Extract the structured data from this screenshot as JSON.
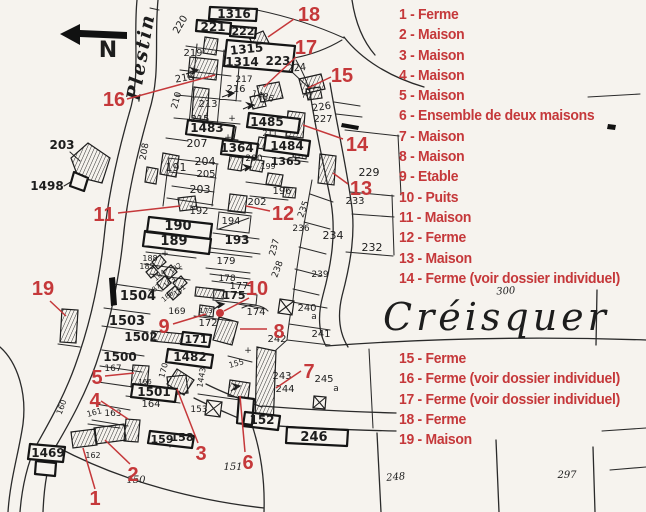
{
  "colors": {
    "red": "#c5383a",
    "ink": "#1d1d1d",
    "paper": "#f6f3ee"
  },
  "place": {
    "name": "Créisquer",
    "road_name": "Plestin",
    "north_label": "N"
  },
  "legend": {
    "group1": [
      "1 - Ferme",
      "2 - Maison",
      "3 - Maison",
      "4 - Maison",
      "5 - Maison",
      "6 - Ensemble de deux maisons",
      "7 - Maison",
      "8 - Maison",
      "9 - Etable",
      "10 - Puits",
      "11 - Maison",
      "12 - Ferme",
      "13 - Maison",
      "14 - Ferme (voir dossier individuel)"
    ],
    "group2": [
      "15 - Ferme",
      "16 - Ferme (voir dossier individuel)",
      "17 - Ferme (voir dossier individuel)",
      "18 - Ferme",
      "19 - Maison"
    ]
  },
  "well_dot": {
    "x": 220,
    "y": 313,
    "r": 4
  },
  "red_markers": [
    {
      "n": "1",
      "x": 95,
      "y": 505,
      "l": [
        95,
        489,
        83,
        448
      ]
    },
    {
      "n": "2",
      "x": 133,
      "y": 481,
      "l": [
        130,
        464,
        105,
        440
      ]
    },
    {
      "n": "3",
      "x": 201,
      "y": 460,
      "l": [
        198,
        443,
        177,
        389
      ]
    },
    {
      "n": "4",
      "x": 95,
      "y": 407,
      "l": [
        101,
        401,
        128,
        419
      ]
    },
    {
      "n": "5",
      "x": 97,
      "y": 384,
      "l": [
        105,
        376,
        134,
        373
      ]
    },
    {
      "n": "6",
      "x": 248,
      "y": 469,
      "l": [
        245,
        452,
        240,
        396
      ]
    },
    {
      "n": "7",
      "x": 309,
      "y": 378,
      "l": [
        301,
        371,
        276,
        388
      ]
    },
    {
      "n": "8",
      "x": 279,
      "y": 338,
      "l": [
        267,
        329,
        240,
        329
      ]
    },
    {
      "n": "9",
      "x": 164,
      "y": 333,
      "l": [
        173,
        324,
        206,
        314
      ]
    },
    {
      "n": "10",
      "x": 257,
      "y": 295,
      "l": [
        249,
        298,
        224,
        311
      ]
    },
    {
      "n": "11",
      "x": 104,
      "y": 221,
      "l": [
        118,
        213,
        180,
        206
      ]
    },
    {
      "n": "12",
      "x": 283,
      "y": 220,
      "l": [
        270,
        211,
        246,
        206
      ]
    },
    {
      "n": "13",
      "x": 361,
      "y": 195,
      "l": [
        348,
        184,
        333,
        173
      ]
    },
    {
      "n": "14",
      "x": 357,
      "y": 151,
      "l": [
        343,
        139,
        303,
        125
      ]
    },
    {
      "n": "15",
      "x": 342,
      "y": 82,
      "l": [
        331,
        77,
        308,
        88
      ]
    },
    {
      "n": "16",
      "x": 114,
      "y": 106,
      "l": [
        127,
        99,
        215,
        75
      ]
    },
    {
      "n": "17",
      "x": 306,
      "y": 54,
      "l": [
        296,
        57,
        264,
        87
      ]
    },
    {
      "n": "18",
      "x": 309,
      "y": 21,
      "l": [
        294,
        19,
        268,
        37
      ]
    },
    {
      "n": "19",
      "x": 43,
      "y": 295,
      "l": [
        50,
        301,
        66,
        316
      ]
    }
  ],
  "map_labels": [
    {
      "t": "1316",
      "x": 234,
      "y": 18,
      "s": 12,
      "c": "b"
    },
    {
      "t": "221",
      "x": 213,
      "y": 31,
      "s": 12,
      "c": "b"
    },
    {
      "t": "222",
      "x": 243,
      "y": 35,
      "s": 11,
      "c": "b"
    },
    {
      "t": "1315",
      "x": 247,
      "y": 53,
      "s": 12,
      "r": -6,
      "c": "b"
    },
    {
      "t": "1314",
      "x": 242,
      "y": 66,
      "s": 12,
      "c": "b"
    },
    {
      "t": "223",
      "x": 278,
      "y": 65,
      "s": 12,
      "c": "b"
    },
    {
      "t": "224",
      "x": 297,
      "y": 71,
      "s": 10,
      "r": -6
    },
    {
      "t": "225",
      "x": 312,
      "y": 93,
      "s": 9,
      "r": -65
    },
    {
      "t": "220",
      "x": 183,
      "y": 26,
      "s": 10,
      "r": -60
    },
    {
      "t": "219",
      "x": 193,
      "y": 56,
      "s": 10
    },
    {
      "t": "218",
      "x": 185,
      "y": 81,
      "s": 10,
      "r": -10
    },
    {
      "t": "217",
      "x": 244,
      "y": 82,
      "s": 9
    },
    {
      "t": "216",
      "x": 236,
      "y": 92,
      "s": 10
    },
    {
      "t": "213",
      "x": 208,
      "y": 107,
      "s": 10
    },
    {
      "t": "215",
      "x": 200,
      "y": 122,
      "s": 10
    },
    {
      "t": "210",
      "x": 179,
      "y": 101,
      "s": 9,
      "r": -75
    },
    {
      "t": "208",
      "x": 147,
      "y": 152,
      "s": 9,
      "r": -80
    },
    {
      "t": "1483",
      "x": 207,
      "y": 132,
      "s": 12,
      "c": "b"
    },
    {
      "t": "207",
      "x": 197,
      "y": 147,
      "s": 11
    },
    {
      "t": "1364",
      "x": 237,
      "y": 152,
      "s": 12,
      "c": "b"
    },
    {
      "t": "1485",
      "x": 267,
      "y": 126,
      "s": 12,
      "c": "b"
    },
    {
      "t": "1486",
      "x": 262,
      "y": 99,
      "s": 9,
      "r": 15
    },
    {
      "t": "1484",
      "x": 287,
      "y": 150,
      "s": 12,
      "c": "b"
    },
    {
      "t": "1365",
      "x": 286,
      "y": 165,
      "s": 11,
      "c": "b"
    },
    {
      "t": "226",
      "x": 322,
      "y": 110,
      "s": 10,
      "r": -8
    },
    {
      "t": "227",
      "x": 323,
      "y": 122,
      "s": 10
    },
    {
      "t": "200",
      "x": 254,
      "y": 161,
      "s": 9
    },
    {
      "t": "199",
      "x": 268,
      "y": 169,
      "s": 8
    },
    {
      "t": "211",
      "x": 270,
      "y": 136,
      "s": 8
    },
    {
      "t": "196",
      "x": 282,
      "y": 194,
      "s": 10
    },
    {
      "t": "191",
      "x": 176,
      "y": 171,
      "s": 11
    },
    {
      "t": "204",
      "x": 205,
      "y": 165,
      "s": 11
    },
    {
      "t": "205",
      "x": 206,
      "y": 177,
      "s": 10
    },
    {
      "t": "203",
      "x": 200,
      "y": 193,
      "s": 11
    },
    {
      "t": "192",
      "x": 199,
      "y": 214,
      "s": 10
    },
    {
      "t": "190",
      "x": 178,
      "y": 230,
      "s": 13,
      "c": "b"
    },
    {
      "t": "189",
      "x": 174,
      "y": 245,
      "s": 13,
      "c": "b"
    },
    {
      "t": "194",
      "x": 231,
      "y": 224,
      "s": 10
    },
    {
      "t": "193",
      "x": 237,
      "y": 244,
      "s": 12,
      "c": "b"
    },
    {
      "t": "202",
      "x": 257,
      "y": 205,
      "s": 10
    },
    {
      "t": "229",
      "x": 369,
      "y": 176,
      "s": 11
    },
    {
      "t": "233",
      "x": 355,
      "y": 204,
      "s": 10
    },
    {
      "t": "234",
      "x": 333,
      "y": 239,
      "s": 11
    },
    {
      "t": "232",
      "x": 372,
      "y": 251,
      "s": 11
    },
    {
      "t": "235",
      "x": 306,
      "y": 210,
      "s": 9,
      "r": -70
    },
    {
      "t": "236",
      "x": 301,
      "y": 231,
      "s": 9
    },
    {
      "t": "237",
      "x": 277,
      "y": 248,
      "s": 9,
      "r": -75
    },
    {
      "t": "238",
      "x": 280,
      "y": 270,
      "s": 9,
      "r": -70
    },
    {
      "t": "239",
      "x": 320,
      "y": 277,
      "s": 9
    },
    {
      "t": "240",
      "x": 307,
      "y": 311,
      "s": 10
    },
    {
      "t": "a",
      "x": 314,
      "y": 319,
      "s": 9
    },
    {
      "t": "241",
      "x": 321,
      "y": 337,
      "s": 10
    },
    {
      "t": "242",
      "x": 277,
      "y": 342,
      "s": 10
    },
    {
      "t": "243",
      "x": 282,
      "y": 379,
      "s": 10
    },
    {
      "t": "244",
      "x": 285,
      "y": 392,
      "s": 10
    },
    {
      "t": "245",
      "x": 324,
      "y": 382,
      "s": 10
    },
    {
      "t": "a",
      "x": 336,
      "y": 391,
      "s": 9
    },
    {
      "t": "179",
      "x": 226,
      "y": 264,
      "s": 10
    },
    {
      "t": "178",
      "x": 227,
      "y": 281,
      "s": 9
    },
    {
      "t": "177",
      "x": 239,
      "y": 289,
      "s": 10
    },
    {
      "t": "175",
      "x": 234,
      "y": 299,
      "s": 11,
      "c": "b"
    },
    {
      "t": "174",
      "x": 256,
      "y": 315,
      "s": 10
    },
    {
      "t": "173",
      "x": 206,
      "y": 313,
      "s": 7
    },
    {
      "t": "172",
      "x": 208,
      "y": 326,
      "s": 10
    },
    {
      "t": "169",
      "x": 177,
      "y": 314,
      "s": 9
    },
    {
      "t": "167",
      "x": 113,
      "y": 371,
      "s": 9
    },
    {
      "t": "170",
      "x": 166,
      "y": 371,
      "s": 8,
      "r": -75
    },
    {
      "t": "166",
      "x": 145,
      "y": 384,
      "s": 7
    },
    {
      "t": "155",
      "x": 237,
      "y": 366,
      "s": 8,
      "r": -15
    },
    {
      "t": "1443",
      "x": 204,
      "y": 378,
      "s": 8,
      "r": -80
    },
    {
      "t": "1504",
      "x": 138,
      "y": 300,
      "s": 13,
      "c": "b"
    },
    {
      "t": "1503",
      "x": 127,
      "y": 325,
      "s": 13,
      "c": "b"
    },
    {
      "t": "1502",
      "x": 141,
      "y": 341,
      "s": 12,
      "c": "b"
    },
    {
      "t": "1500",
      "x": 120,
      "y": 361,
      "s": 12,
      "c": "b"
    },
    {
      "t": "171",
      "x": 196,
      "y": 343,
      "s": 11,
      "c": "b"
    },
    {
      "t": "1482",
      "x": 190,
      "y": 361,
      "s": 12,
      "c": "b"
    },
    {
      "t": "1501",
      "x": 154,
      "y": 396,
      "s": 12,
      "c": "b"
    },
    {
      "t": "164",
      "x": 151,
      "y": 407,
      "s": 10
    },
    {
      "t": "163",
      "x": 113,
      "y": 416,
      "s": 9
    },
    {
      "t": "161",
      "x": 95,
      "y": 415,
      "s": 8,
      "r": -15
    },
    {
      "t": "160",
      "x": 64,
      "y": 408,
      "s": 8,
      "r": -70
    },
    {
      "t": "162",
      "x": 93,
      "y": 458,
      "s": 8
    },
    {
      "t": "1469",
      "x": 48,
      "y": 457,
      "s": 12,
      "c": "b"
    },
    {
      "t": "159",
      "x": 162,
      "y": 443,
      "s": 11,
      "c": "b"
    },
    {
      "t": "158",
      "x": 182,
      "y": 441,
      "s": 11,
      "c": "b"
    },
    {
      "t": "153",
      "x": 199,
      "y": 412,
      "s": 9
    },
    {
      "t": "152",
      "x": 262,
      "y": 424,
      "s": 12,
      "c": "b"
    },
    {
      "t": "151",
      "x": 233,
      "y": 470,
      "s": 10,
      "c": "i"
    },
    {
      "t": "150",
      "x": 136,
      "y": 483,
      "s": 10,
      "c": "i"
    },
    {
      "t": "246",
      "x": 314,
      "y": 441,
      "s": 13,
      "c": "b"
    },
    {
      "t": "248",
      "x": 396,
      "y": 480,
      "s": 10,
      "r": -5,
      "c": "i"
    },
    {
      "t": "297",
      "x": 567,
      "y": 478,
      "s": 10,
      "c": "i"
    },
    {
      "t": "300",
      "x": 506,
      "y": 294,
      "s": 10,
      "r": -4,
      "c": "i"
    },
    {
      "t": "188",
      "x": 150,
      "y": 261,
      "s": 8
    },
    {
      "t": "185",
      "x": 147,
      "y": 269,
      "s": 8
    },
    {
      "t": "184",
      "x": 161,
      "y": 277,
      "s": 7,
      "r": -40
    },
    {
      "t": "183",
      "x": 171,
      "y": 284,
      "s": 7,
      "r": -40
    },
    {
      "t": "182",
      "x": 177,
      "y": 270,
      "s": 7,
      "r": -40
    },
    {
      "t": "181",
      "x": 181,
      "y": 292,
      "s": 7,
      "r": -40
    },
    {
      "t": "187",
      "x": 156,
      "y": 291,
      "s": 7,
      "r": -40
    },
    {
      "t": "186",
      "x": 169,
      "y": 298,
      "s": 7,
      "r": -40
    },
    {
      "t": "203",
      "x": 62,
      "y": 149,
      "s": 12,
      "c": "b"
    },
    {
      "t": "1498",
      "x": 47,
      "y": 190,
      "s": 12,
      "c": "b"
    },
    {
      "t": "+",
      "x": 232,
      "y": 121,
      "s": 9
    },
    {
      "t": "+",
      "x": 165,
      "y": 256,
      "s": 9
    },
    {
      "t": "+",
      "x": 248,
      "y": 353,
      "s": 9
    },
    {
      "t": "+",
      "x": 228,
      "y": 140,
      "s": 9
    },
    {
      "t": "N",
      "x": 108,
      "y": 57,
      "s": 22,
      "c": "n"
    },
    {
      "t": "Plestin",
      "x": 147,
      "y": 58,
      "s": 19,
      "r": -80,
      "c": "road"
    },
    {
      "t": "Créisquer",
      "x": 383,
      "y": 330,
      "s": 38,
      "c": "place"
    }
  ]
}
